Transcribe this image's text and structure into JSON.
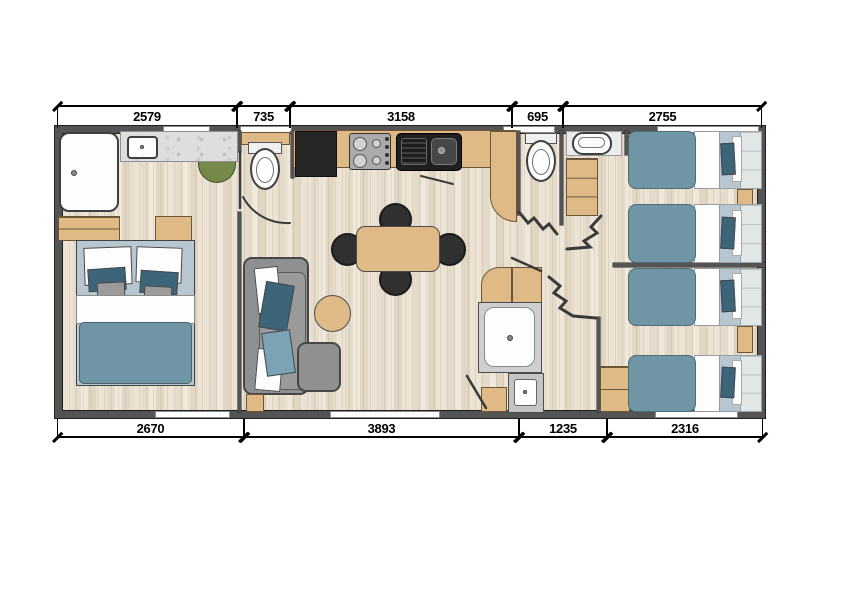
{
  "dimensions": {
    "top": [
      "2579",
      "735",
      "3158",
      "695",
      "2755"
    ],
    "bottom": [
      "2670",
      "3893",
      "1235",
      "2316"
    ]
  },
  "colors": {
    "wall_gray": "#545454",
    "floor_wood": "#e8dfd0",
    "cabinet_tan": "#dfba86",
    "bedding_blue": "#7095a4",
    "pillow_navy": "#3c657a",
    "mattress_blue_gray": "#b8c7cf",
    "headboard_gray": "#e3e6e7",
    "sofa_gray": "#8f8f8f",
    "mat_green": "#77894a",
    "appliance_black": "#262626",
    "marble_gray": "#dedede",
    "fixture_white": "#fdfdfd"
  },
  "furniture": [
    "bathtub",
    "vanity-sink",
    "green-mat",
    "double-bed",
    "wc-toilet-1",
    "fridge",
    "stove",
    "kitchen-sink",
    "dining-table",
    "dining-chairs",
    "sofa",
    "coffee-table",
    "peninsula-counter",
    "wc-toilet-2",
    "washroom-basin",
    "shower",
    "washbasin",
    "accordion-doors",
    "single-bed-1",
    "single-bed-2",
    "single-bed-3",
    "single-bed-4",
    "wardrobe-cabinets"
  ]
}
